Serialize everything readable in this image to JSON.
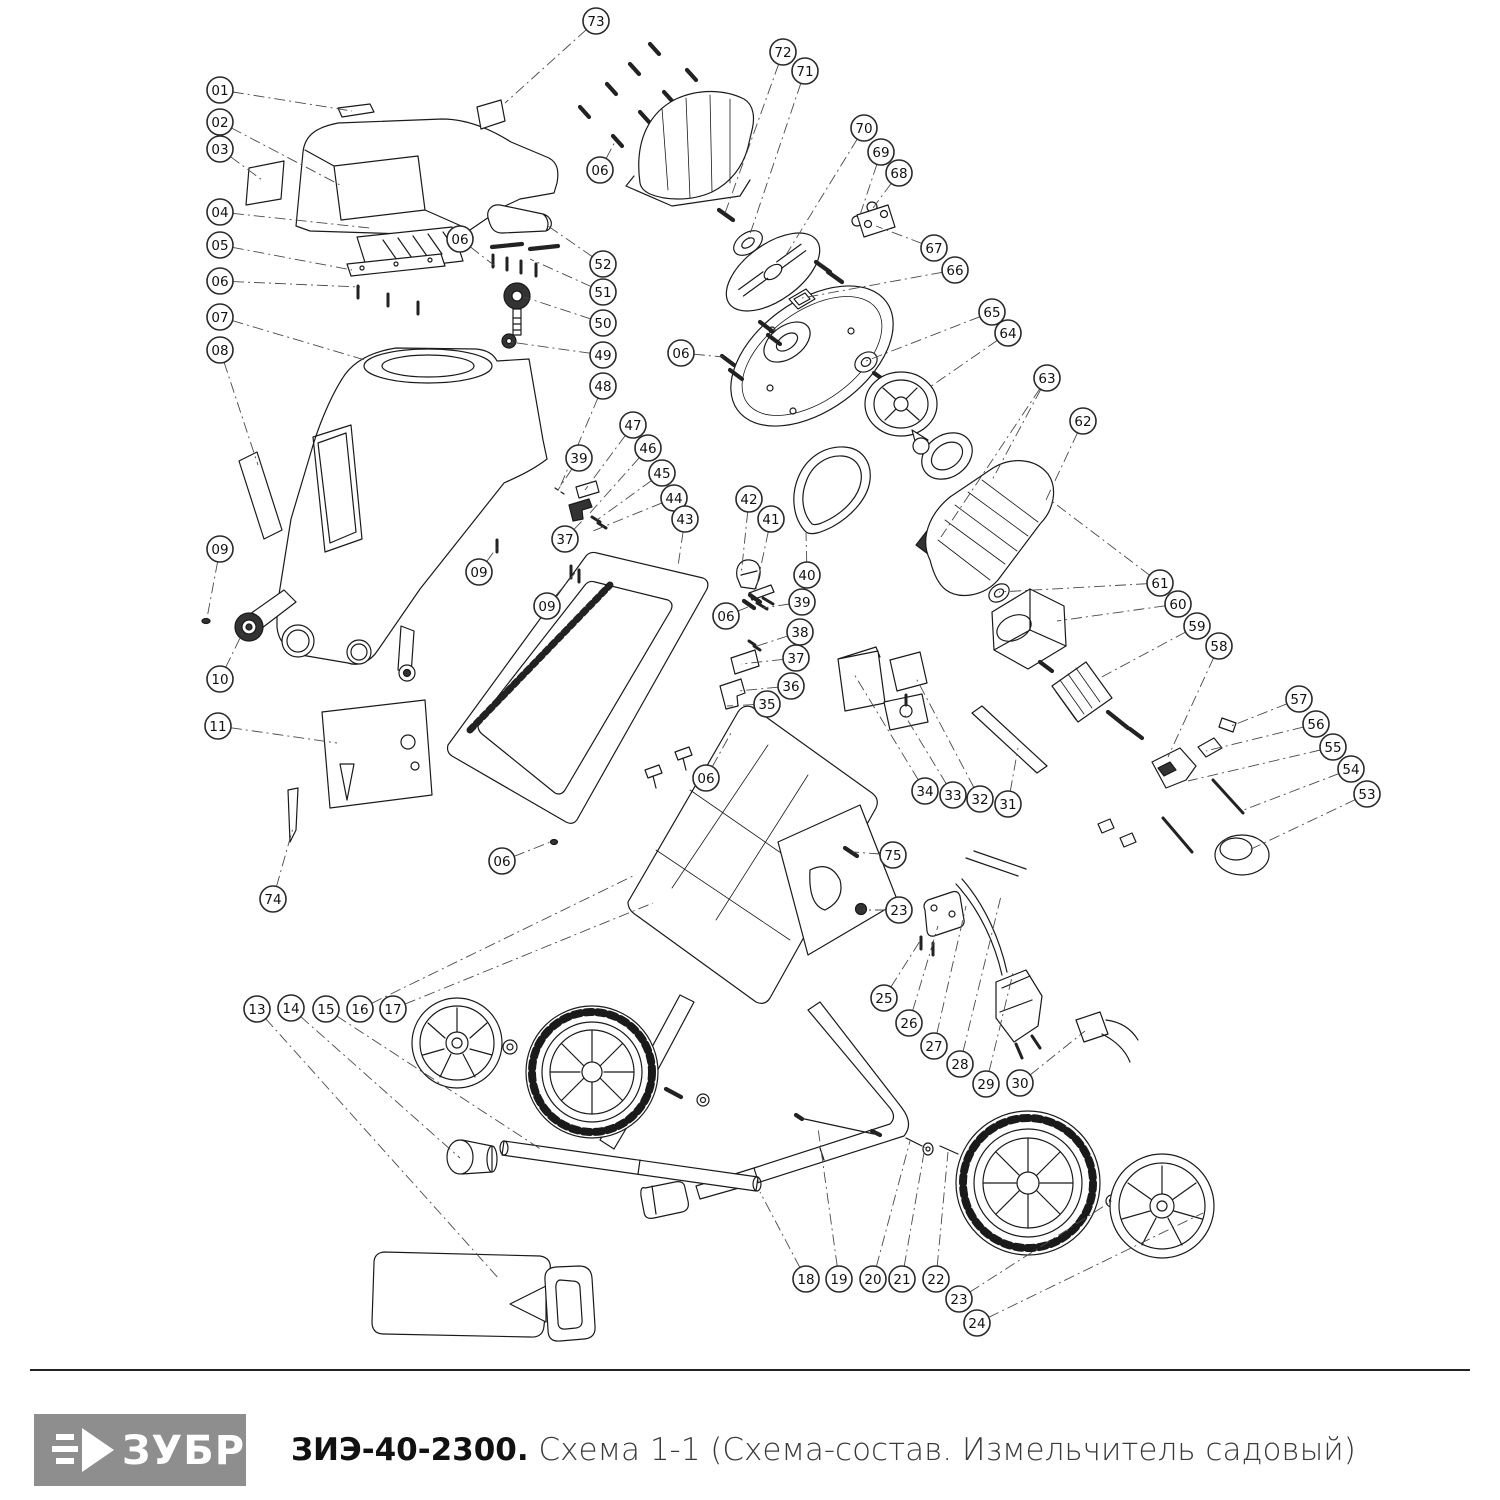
{
  "footer": {
    "logo_text": "ЗУБР",
    "logo_bg": "#8e8e8e",
    "title_bold": "ЗИЭ-40-2300.",
    "title_rest": " Схема 1-1 (Схема-состав. Измельчитель садовый)"
  },
  "diagram": {
    "stroke_color": "#1a1a1a",
    "leader_color": "#4a4a4a",
    "callout_radius": 13,
    "callouts": [
      {
        "n": "01",
        "x": 220,
        "y": 90,
        "t": [
          [
            352,
            111
          ]
        ]
      },
      {
        "n": "02",
        "x": 220,
        "y": 122,
        "t": [
          [
            340,
            185
          ]
        ]
      },
      {
        "n": "03",
        "x": 220,
        "y": 149,
        "t": [
          [
            262,
            180
          ]
        ]
      },
      {
        "n": "04",
        "x": 220,
        "y": 212,
        "t": [
          [
            370,
            228
          ]
        ]
      },
      {
        "n": "05",
        "x": 220,
        "y": 245,
        "t": [
          [
            352,
            270
          ]
        ]
      },
      {
        "n": "06",
        "x": 220,
        "y": 281,
        "t": [
          [
            360,
            287
          ]
        ]
      },
      {
        "n": "07",
        "x": 220,
        "y": 317,
        "t": [
          [
            365,
            360
          ]
        ]
      },
      {
        "n": "08",
        "x": 220,
        "y": 350,
        "t": [
          [
            258,
            465
          ]
        ]
      },
      {
        "n": "09",
        "x": 220,
        "y": 549,
        "t": [
          [
            207,
            618
          ]
        ]
      },
      {
        "n": "10",
        "x": 220,
        "y": 679,
        "t": [
          [
            243,
            632
          ]
        ]
      },
      {
        "n": "11",
        "x": 218,
        "y": 726,
        "t": [
          [
            337,
            743
          ]
        ]
      },
      {
        "n": "74",
        "x": 273,
        "y": 899,
        "t": [
          [
            293,
            828
          ]
        ]
      },
      {
        "n": "73",
        "x": 596,
        "y": 21,
        "t": [
          [
            505,
            103
          ]
        ]
      },
      {
        "n": "06",
        "x": 600,
        "y": 170,
        "t": [
          [
            616,
            140
          ]
        ]
      },
      {
        "n": "06",
        "x": 460,
        "y": 239,
        "t": [
          [
            495,
            266
          ]
        ]
      },
      {
        "n": "52",
        "x": 603,
        "y": 264,
        "t": [
          [
            548,
            226
          ]
        ]
      },
      {
        "n": "51",
        "x": 603,
        "y": 292,
        "t": [
          [
            530,
            259
          ]
        ]
      },
      {
        "n": "50",
        "x": 603,
        "y": 323,
        "t": [
          [
            524,
            297
          ]
        ]
      },
      {
        "n": "49",
        "x": 603,
        "y": 355,
        "t": [
          [
            510,
            342
          ]
        ]
      },
      {
        "n": "48",
        "x": 603,
        "y": 386,
        "t": [
          [
            560,
            487
          ]
        ]
      },
      {
        "n": "72",
        "x": 783,
        "y": 52,
        "t": [
          [
            724,
            216
          ]
        ]
      },
      {
        "n": "71",
        "x": 805,
        "y": 71,
        "t": [
          [
            748,
            240
          ]
        ]
      },
      {
        "n": "70",
        "x": 864,
        "y": 128,
        "t": [
          [
            786,
            255
          ]
        ]
      },
      {
        "n": "69",
        "x": 881,
        "y": 152,
        "t": [
          [
            858,
            221
          ]
        ]
      },
      {
        "n": "68",
        "x": 899,
        "y": 173,
        "t": [
          [
            873,
            208
          ]
        ]
      },
      {
        "n": "67",
        "x": 934,
        "y": 248,
        "t": [
          [
            876,
            226
          ]
        ]
      },
      {
        "n": "66",
        "x": 955,
        "y": 270,
        "t": [
          [
            802,
            298
          ]
        ]
      },
      {
        "n": "65",
        "x": 992,
        "y": 312,
        "t": [
          [
            866,
            361
          ]
        ]
      },
      {
        "n": "64",
        "x": 1008,
        "y": 333,
        "t": [
          [
            930,
            387
          ]
        ]
      },
      {
        "n": "63",
        "x": 1047,
        "y": 378,
        "t": [
          [
            991,
            482
          ],
          [
            941,
            537
          ]
        ]
      },
      {
        "n": "62",
        "x": 1083,
        "y": 421,
        "t": [
          [
            1046,
            500
          ]
        ]
      },
      {
        "n": "61",
        "x": 1160,
        "y": 583,
        "t": [
          [
            1049,
            499
          ],
          [
            999,
            592
          ]
        ]
      },
      {
        "n": "60",
        "x": 1178,
        "y": 604,
        "t": [
          [
            1057,
            621
          ]
        ]
      },
      {
        "n": "59",
        "x": 1197,
        "y": 626,
        "t": [
          [
            1098,
            679
          ]
        ]
      },
      {
        "n": "58",
        "x": 1219,
        "y": 646,
        "t": [
          [
            1168,
            757
          ]
        ]
      },
      {
        "n": "57",
        "x": 1299,
        "y": 699,
        "t": [
          [
            1231,
            726
          ]
        ]
      },
      {
        "n": "56",
        "x": 1316,
        "y": 724,
        "t": [
          [
            1206,
            751
          ]
        ]
      },
      {
        "n": "55",
        "x": 1333,
        "y": 747,
        "t": [
          [
            1188,
            781
          ]
        ]
      },
      {
        "n": "54",
        "x": 1351,
        "y": 769,
        "t": [
          [
            1241,
            811
          ]
        ]
      },
      {
        "n": "53",
        "x": 1367,
        "y": 794,
        "t": [
          [
            1247,
            851
          ]
        ]
      },
      {
        "n": "06",
        "x": 681,
        "y": 353,
        "t": [
          [
            723,
            357
          ]
        ]
      },
      {
        "n": "47",
        "x": 633,
        "y": 425,
        "t": [
          [
            585,
            490
          ]
        ]
      },
      {
        "n": "46",
        "x": 648,
        "y": 448,
        "t": [
          [
            590,
            513
          ]
        ]
      },
      {
        "n": "45",
        "x": 662,
        "y": 473,
        "t": [
          [
            597,
            520
          ]
        ]
      },
      {
        "n": "44",
        "x": 674,
        "y": 498,
        "t": [
          [
            593,
            531
          ]
        ]
      },
      {
        "n": "43",
        "x": 685,
        "y": 519,
        "t": [
          [
            678,
            566
          ]
        ]
      },
      {
        "n": "39",
        "x": 579,
        "y": 458,
        "t": [
          [
            558,
            490
          ]
        ]
      },
      {
        "n": "37",
        "x": 565,
        "y": 539,
        "t": [
          [
            582,
            521
          ]
        ]
      },
      {
        "n": "09",
        "x": 479,
        "y": 572,
        "t": [
          [
            498,
            546
          ]
        ]
      },
      {
        "n": "09",
        "x": 547,
        "y": 606,
        "t": [
          [
            575,
            573
          ]
        ]
      },
      {
        "n": "42",
        "x": 749,
        "y": 499,
        "t": [
          [
            741,
            576
          ]
        ]
      },
      {
        "n": "41",
        "x": 771,
        "y": 519,
        "t": [
          [
            756,
            589
          ]
        ]
      },
      {
        "n": "40",
        "x": 807,
        "y": 575,
        "t": [
          [
            806,
            533
          ]
        ]
      },
      {
        "n": "39",
        "x": 802,
        "y": 602,
        "t": [
          [
            763,
            608
          ]
        ]
      },
      {
        "n": "38",
        "x": 800,
        "y": 632,
        "t": [
          [
            754,
            647
          ]
        ]
      },
      {
        "n": "37",
        "x": 796,
        "y": 658,
        "t": [
          [
            741,
            664
          ]
        ]
      },
      {
        "n": "36",
        "x": 791,
        "y": 686,
        "t": [
          [
            738,
            691
          ]
        ]
      },
      {
        "n": "35",
        "x": 767,
        "y": 704,
        "t": [
          [
            727,
            706
          ]
        ]
      },
      {
        "n": "06",
        "x": 726,
        "y": 616,
        "t": [
          [
            748,
            607
          ]
        ]
      },
      {
        "n": "06",
        "x": 706,
        "y": 778,
        "t": [
          [
            731,
            733
          ]
        ]
      },
      {
        "n": "34",
        "x": 925,
        "y": 791,
        "t": [
          [
            854,
            674
          ]
        ]
      },
      {
        "n": "33",
        "x": 953,
        "y": 795,
        "t": [
          [
            904,
            714
          ]
        ]
      },
      {
        "n": "32",
        "x": 980,
        "y": 799,
        "t": [
          [
            916,
            678
          ]
        ]
      },
      {
        "n": "31",
        "x": 1008,
        "y": 804,
        "t": [
          [
            1018,
            748
          ]
        ]
      },
      {
        "n": "06",
        "x": 502,
        "y": 861,
        "t": [
          [
            553,
            841
          ]
        ]
      },
      {
        "n": "75",
        "x": 893,
        "y": 855,
        "t": [
          [
            853,
            852
          ]
        ]
      },
      {
        "n": "23",
        "x": 899,
        "y": 910,
        "t": [
          [
            863,
            910
          ]
        ]
      },
      {
        "n": "25",
        "x": 884,
        "y": 998,
        "t": [
          [
            920,
            941
          ]
        ]
      },
      {
        "n": "26",
        "x": 909,
        "y": 1023,
        "t": [
          [
            938,
            926
          ]
        ]
      },
      {
        "n": "27",
        "x": 934,
        "y": 1046,
        "t": [
          [
            966,
            906
          ]
        ]
      },
      {
        "n": "28",
        "x": 960,
        "y": 1064,
        "t": [
          [
            1001,
            896
          ]
        ]
      },
      {
        "n": "29",
        "x": 986,
        "y": 1084,
        "t": [
          [
            1013,
            973
          ]
        ]
      },
      {
        "n": "30",
        "x": 1020,
        "y": 1083,
        "t": [
          [
            1085,
            1031
          ]
        ]
      },
      {
        "n": "13",
        "x": 257,
        "y": 1009,
        "t": [
          [
            500,
            1280
          ]
        ]
      },
      {
        "n": "14",
        "x": 291,
        "y": 1008,
        "t": [
          [
            460,
            1158
          ]
        ]
      },
      {
        "n": "15",
        "x": 326,
        "y": 1009,
        "t": [
          [
            542,
            1150
          ]
        ]
      },
      {
        "n": "16",
        "x": 360,
        "y": 1009,
        "t": [
          [
            635,
            875
          ]
        ]
      },
      {
        "n": "17",
        "x": 393,
        "y": 1009,
        "t": [
          [
            653,
            903
          ]
        ]
      },
      {
        "n": "18",
        "x": 806,
        "y": 1279,
        "t": [
          [
            760,
            1192
          ]
        ]
      },
      {
        "n": "19",
        "x": 839,
        "y": 1279,
        "t": [
          [
            818,
            1128
          ]
        ]
      },
      {
        "n": "20",
        "x": 873,
        "y": 1279,
        "t": [
          [
            910,
            1141
          ]
        ]
      },
      {
        "n": "21",
        "x": 902,
        "y": 1279,
        "t": [
          [
            925,
            1147
          ]
        ]
      },
      {
        "n": "22",
        "x": 936,
        "y": 1279,
        "t": [
          [
            948,
            1152
          ]
        ]
      },
      {
        "n": "23",
        "x": 959,
        "y": 1299,
        "t": [
          [
            1112,
            1201
          ]
        ]
      },
      {
        "n": "24",
        "x": 977,
        "y": 1323,
        "t": [
          [
            1203,
            1213
          ]
        ]
      }
    ]
  }
}
